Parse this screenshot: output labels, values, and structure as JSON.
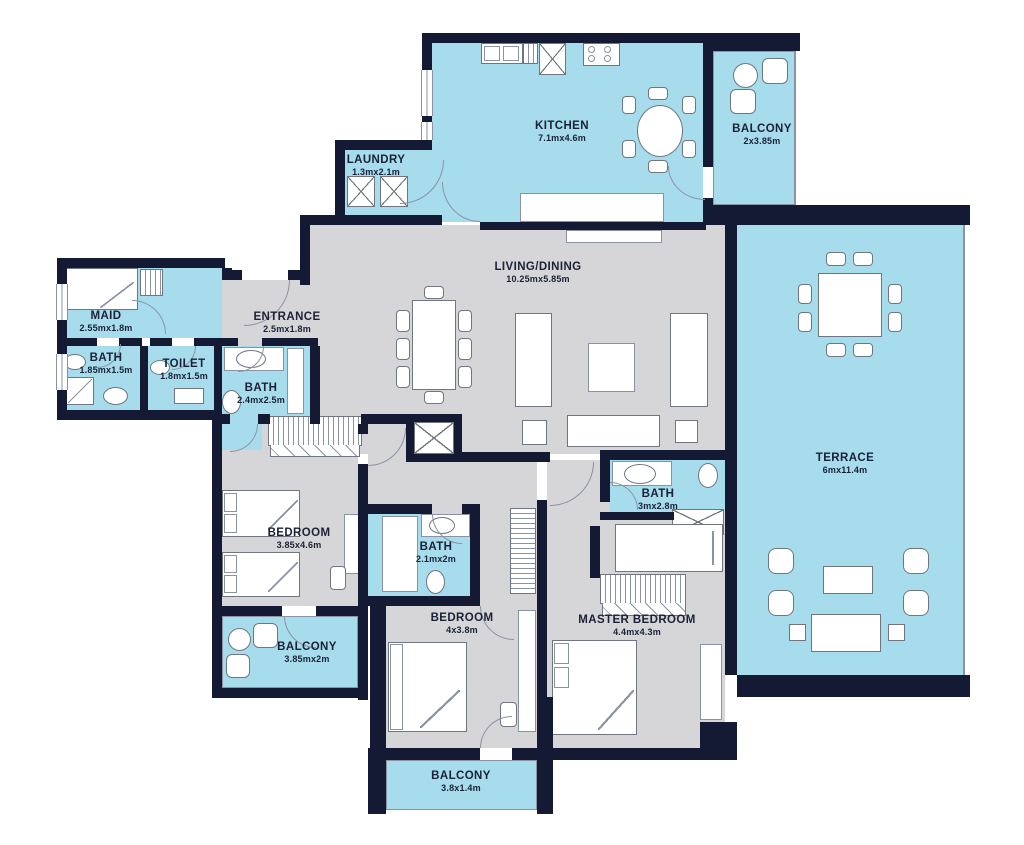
{
  "colors": {
    "bg": "#ffffff",
    "wall": "#151a34",
    "room_blue": "#a6dcec",
    "room_gray": "#d6d6d8",
    "furn_line": "#6f7682",
    "thin_line": "#8a93a3",
    "text": "#1b2136"
  },
  "rooms": [
    {
      "id": "kitchen",
      "name": "KITCHEN",
      "dims": "7.1mx4.6m"
    },
    {
      "id": "balcony-top",
      "name": "BALCONY",
      "dims": "2x3.85m"
    },
    {
      "id": "laundry",
      "name": "LAUNDRY",
      "dims": "1.3mx2.1m"
    },
    {
      "id": "living-dining",
      "name": "LIVING/DINING",
      "dims": "10.25mx5.85m"
    },
    {
      "id": "maid",
      "name": "MAID",
      "dims": "2.55mx1.8m"
    },
    {
      "id": "maid-bath",
      "name": "BATH",
      "dims": "1.85mx1.5m"
    },
    {
      "id": "toilet",
      "name": "TOILET",
      "dims": "1.8mx1.5m"
    },
    {
      "id": "entrance",
      "name": "ENTRANCE",
      "dims": "2.5mx1.8m"
    },
    {
      "id": "guest-bath",
      "name": "BATH",
      "dims": "2.4mx2.5m"
    },
    {
      "id": "bedroom-1",
      "name": "BEDROOM",
      "dims": "3.85x4.6m"
    },
    {
      "id": "balcony-left",
      "name": "BALCONY",
      "dims": "3.85mx2m"
    },
    {
      "id": "bath-2",
      "name": "BATH",
      "dims": "2.1mx2m"
    },
    {
      "id": "bedroom-2",
      "name": "BEDROOM",
      "dims": "4x3.8m"
    },
    {
      "id": "master-bath",
      "name": "BATH",
      "dims": "3mx2.8m"
    },
    {
      "id": "master-bedroom",
      "name": "MASTER BEDROOM",
      "dims": "4.4mx4.3m"
    },
    {
      "id": "terrace",
      "name": "TERRACE",
      "dims": "6mx11.4m"
    },
    {
      "id": "balcony-bottom",
      "name": "BALCONY",
      "dims": "3.8x1.4m"
    }
  ]
}
